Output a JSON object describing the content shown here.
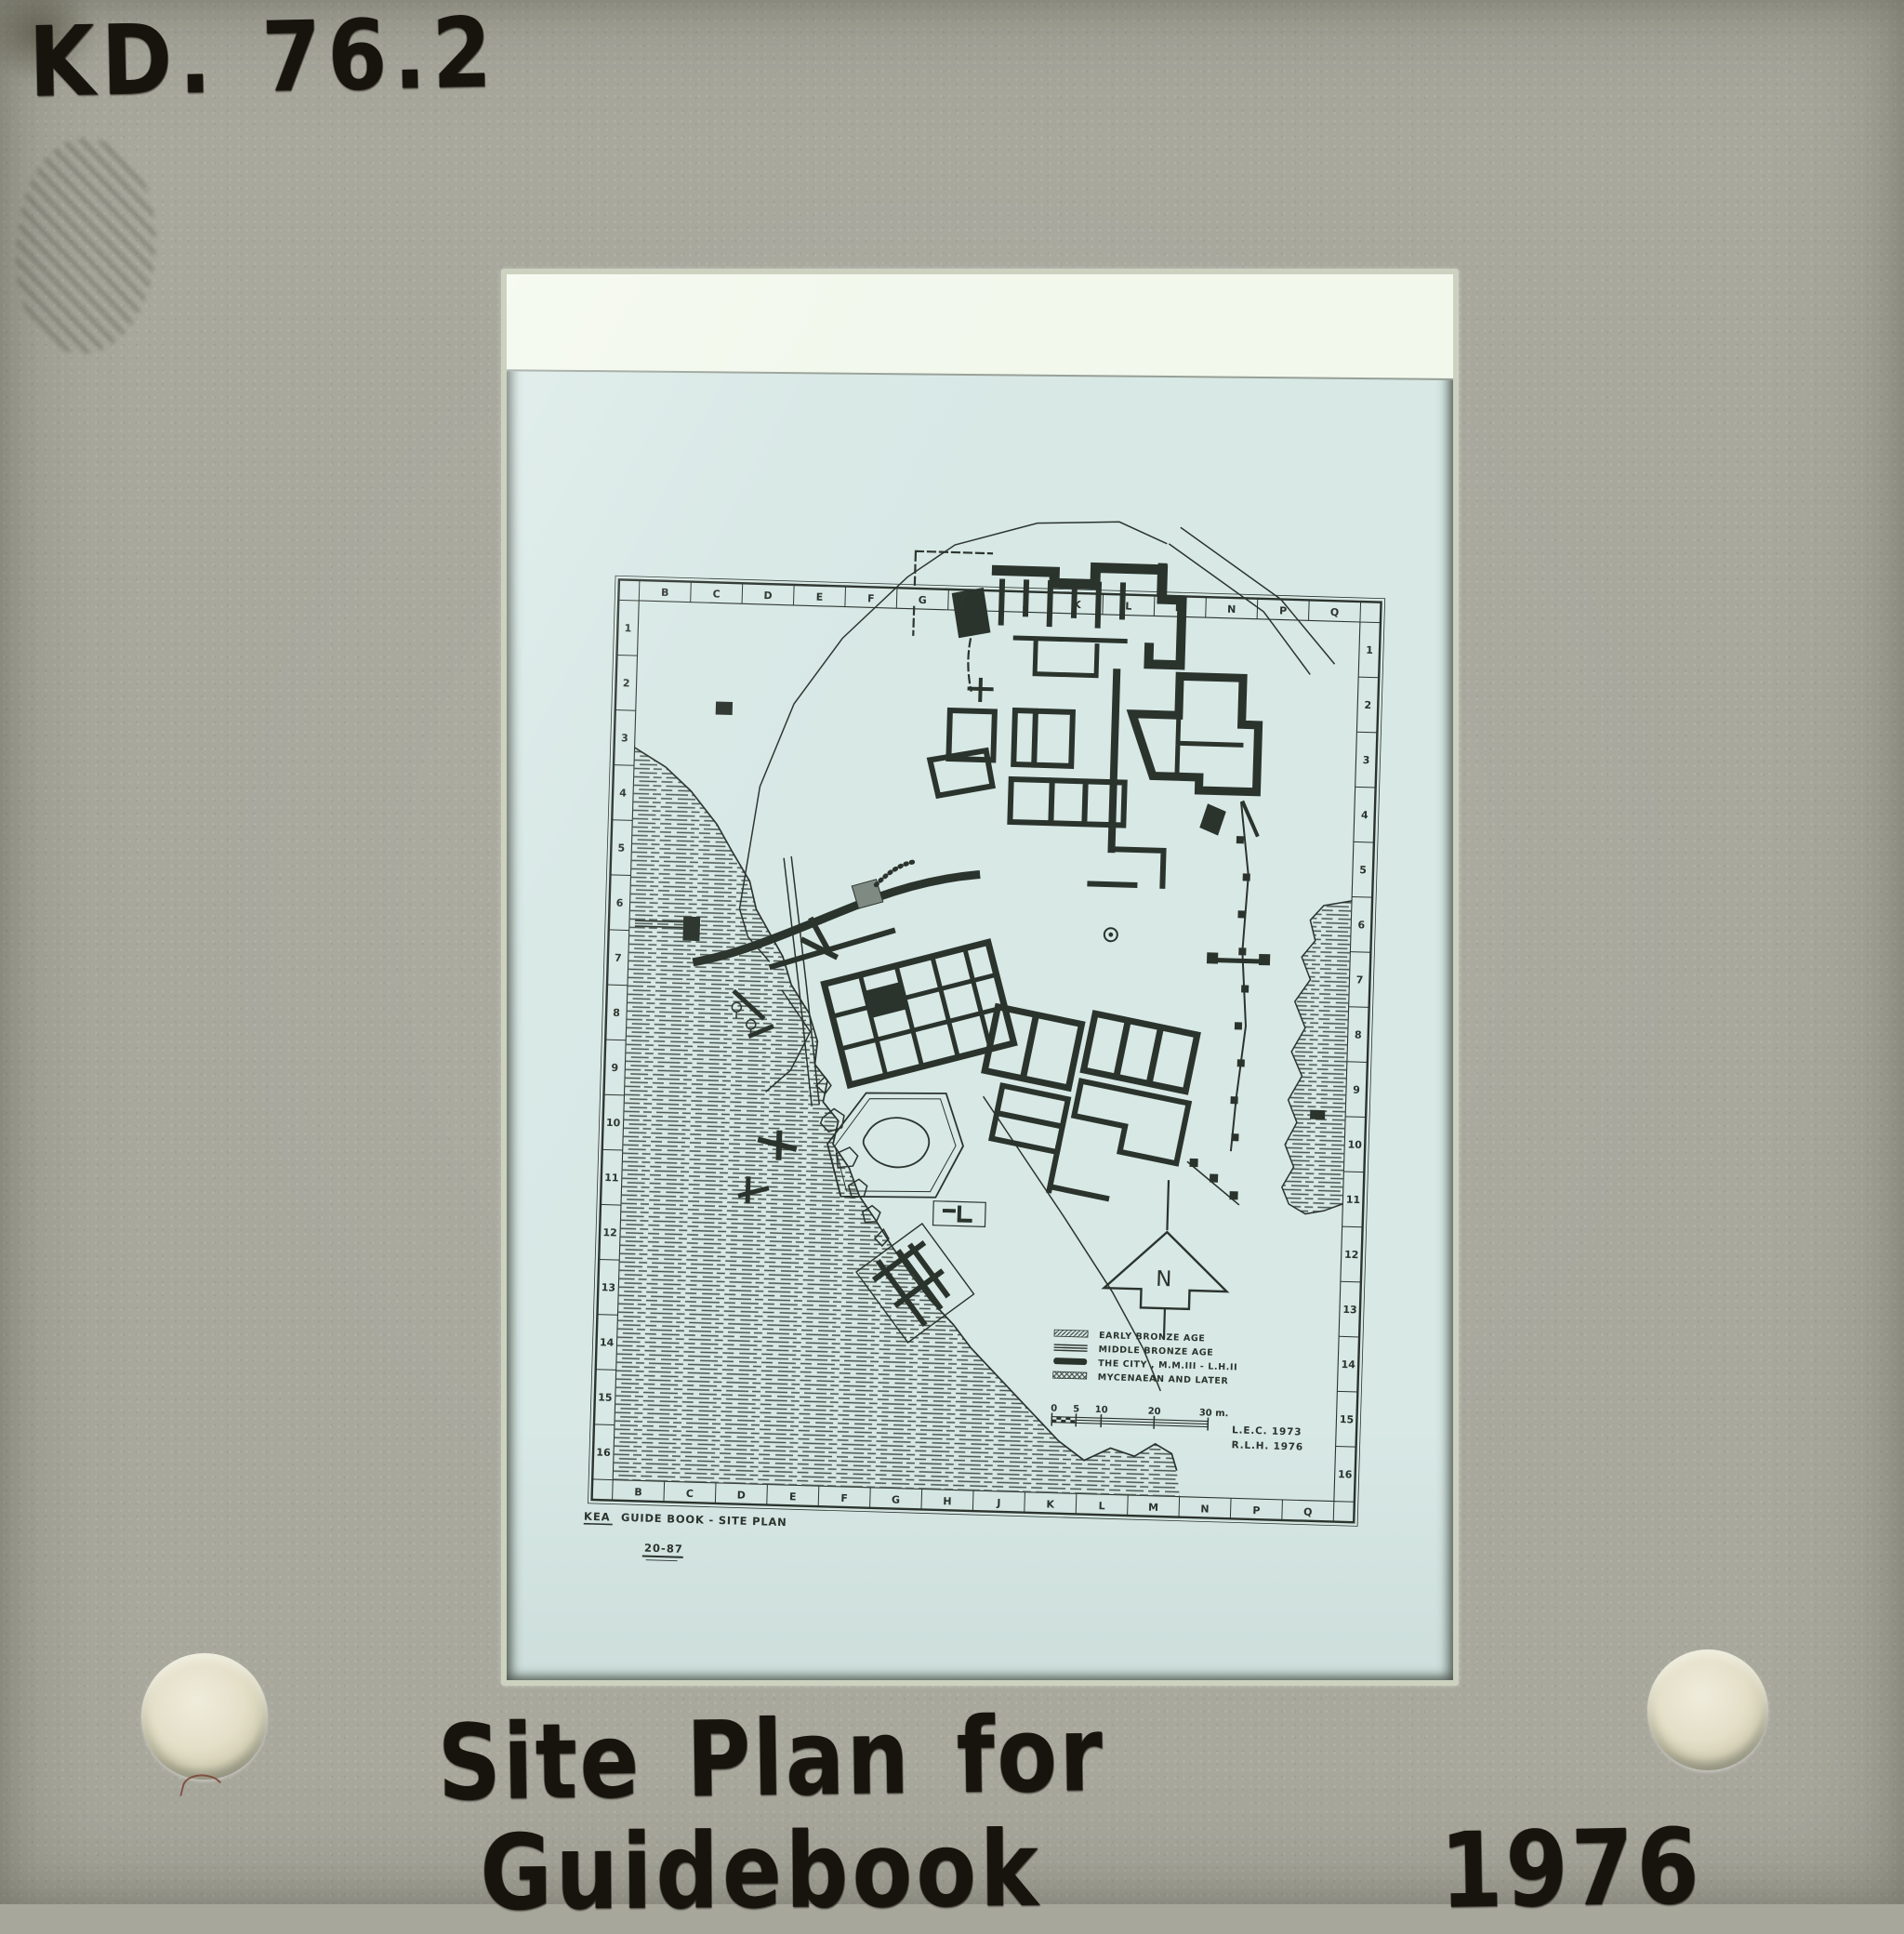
{
  "slide": {
    "catalog_number": "KD. 76.2",
    "caption_line1": "Site Plan for",
    "caption_line2": "Guidebook",
    "caption_year": "1976"
  },
  "sheet": {
    "title_kea": "KEA",
    "title_rest": "GUIDE BOOK - SITE PLAN",
    "figure_number": "20-87"
  },
  "map": {
    "grid_letters": [
      "B",
      "C",
      "D",
      "E",
      "F",
      "G",
      "H",
      "J",
      "K",
      "L",
      "M",
      "N",
      "P",
      "Q"
    ],
    "row_numbers": [
      "1",
      "2",
      "3",
      "4",
      "5",
      "6",
      "7",
      "8",
      "9",
      "10",
      "11",
      "12",
      "13",
      "14",
      "15",
      "16"
    ],
    "north_label": "N",
    "legend_labels": [
      "EARLY  BRONZE  AGE",
      "MIDDLE  BRONZE  AGE",
      "THE  CITY , M.M.III - L.H.II",
      "MYCENAEAN  AND  LATER"
    ],
    "scale_labels": [
      "0",
      "5",
      "10",
      "20",
      "30 m."
    ],
    "credits": [
      "L.E.C.  1973",
      "R.L.H.  1976"
    ]
  },
  "colors": {
    "mount": "#a8a89d",
    "film": "#d7e8e5",
    "film_clear": "#f2f8ec",
    "ink": "#2b332d",
    "marker": "#17130d"
  }
}
